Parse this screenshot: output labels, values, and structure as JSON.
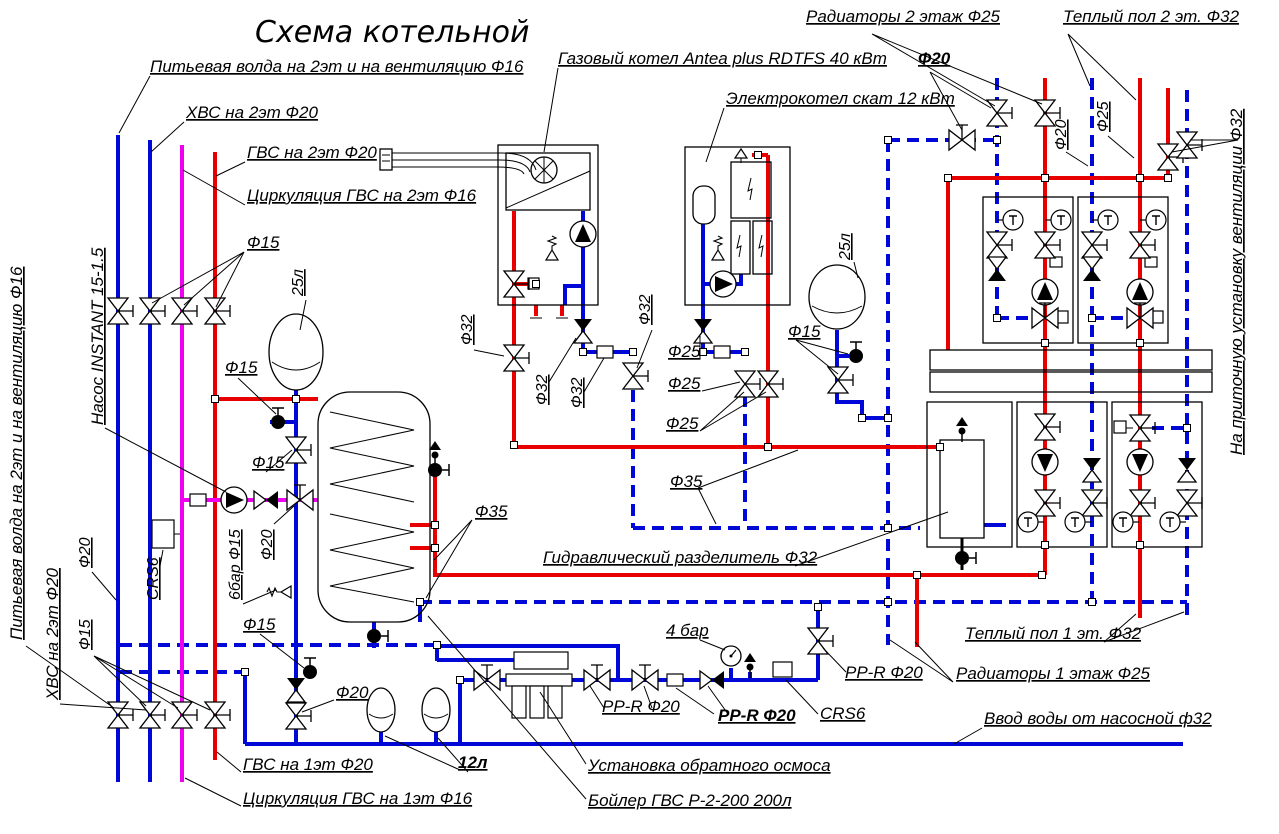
{
  "title": "Схема котельной",
  "colors": {
    "pipe_cold_blue": "#0008d8",
    "pipe_hot_red": "#e80000",
    "pipe_circulation_magenta": "#f000f0",
    "line_black": "#000000",
    "background": "#ffffff"
  },
  "icons": {
    "valve-icon": "bowtie gate valve",
    "check-valve-icon": "half-filled bowtie check valve",
    "pump-icon": "circle with filled triangle",
    "thermometer-icon": "circle with letter T",
    "ball-valve-icon": "filled ball with T-handle",
    "air-vent-icon": "filled triangle over ball",
    "safety-valve-icon": "spring relief valve",
    "pressure-gauge-icon": "round gauge with needle",
    "expansion-tank-icon": "membrane expansion vessel",
    "node-icon": "pipe junction square"
  },
  "labels": {
    "title": "Схема котельной",
    "drinking_top": "Питьевая волда на 2эт и на вентиляцию Ф16",
    "hvs_top": "ХВС на 2эт Ф20",
    "gvs_top": "ГВС на 2эт Ф20",
    "gvs_circ_top": "Циркуляция ГВС на 2эт Ф16",
    "gas_boiler": "Газовый котел Antea plus RDTFS 40 кВт",
    "electric_boiler": "Электрокотел скат 12 кВт",
    "radiators_2f": "Радиаторы 2 этаж Ф25",
    "floor_heating_2f": "Теплый пол 2 эт. Ф32",
    "f20_top": "Ф20",
    "f20_riser": "Ф20",
    "f25_riser": "Ф25",
    "vent_unit": "На приточную установку вентиляции Ф32",
    "pump_instant": "Насос INSTANT 15-1.5",
    "f15_valves": "Ф15",
    "tank25_left": "25л",
    "f15_a": "Ф15",
    "f15_b": "Ф15",
    "drinking_left": "Питьевая волда на 2эт и на вентиляцию Ф16",
    "hvs_left": "ХВС на 2эт Ф20",
    "f20_left": "Ф20",
    "f15_left": "Ф15",
    "crs6_left": "CRS6",
    "bar6_f15": "6бар Ф15",
    "f20_mag": "Ф20",
    "f15_drain": "Ф15",
    "f20_feed": "Ф20",
    "gvs_1f": "ГВС на 1эт Ф20",
    "gvs_circ_1f": "Циркуляция ГВС на 1эт Ф16",
    "tank12": "12л",
    "f32_a": "Ф32",
    "f32_b": "Ф32",
    "f32_c": "Ф32",
    "f32_d": "Ф32",
    "f25_a": "Ф25",
    "f25_b": "Ф25",
    "f25_c": "Ф25",
    "f35_a": "Ф35",
    "f35_b": "Ф35",
    "f15_tank": "Ф15",
    "tank25_right": "25л",
    "separator": "Гидравлический разделитель Ф32",
    "floor_heating_1f": "Теплый пол 1 эт. Ф32",
    "radiators_1f": "Радиаторы 1 этаж Ф25",
    "bar4": "4 бар",
    "ppr_a": "PP-R Ф20",
    "ppr_b": "PP-R Ф20",
    "ppr_c": "PP-R Ф20",
    "crs6_bottom": "CRS6",
    "water_inlet": "Ввод воды от насосной ф32",
    "osmosis": "Установка обратного осмоса",
    "boiler_dhw": "Бойлер ГВС Р-2-200 200л"
  }
}
